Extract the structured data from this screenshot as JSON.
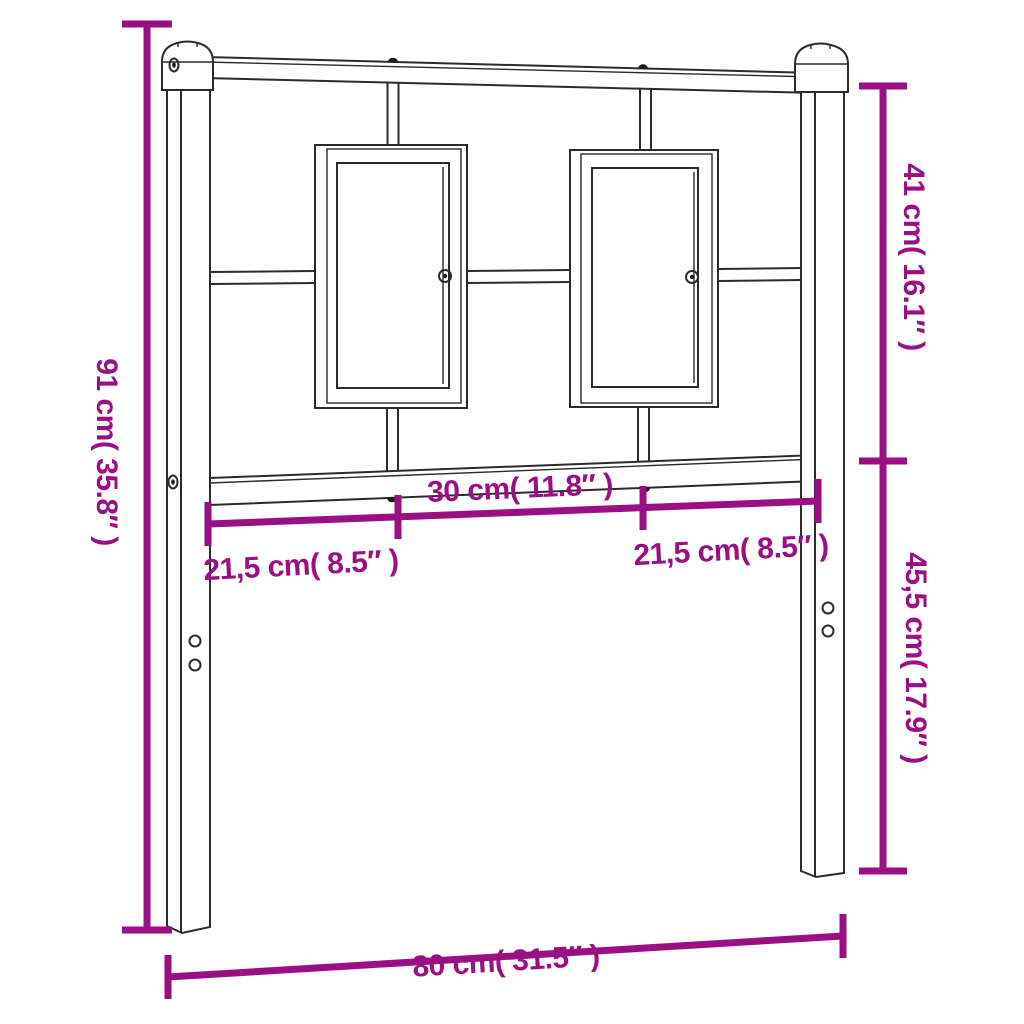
{
  "figure": {
    "type": "product-dimension-diagram",
    "subject": "metal-headboard",
    "colors": {
      "dimension_annotation": "#9A0F82",
      "drawing_outline": "#2B2B2B",
      "background": "#FFFFFF"
    },
    "dimensions": {
      "total_height": {
        "cm": "91",
        "in": "35.8",
        "label": "91 cm( 35.8″ )"
      },
      "upper_section_height": {
        "cm": "41",
        "in": "16.1",
        "label": "41 cm( 16.1″ )"
      },
      "lower_section_height": {
        "cm": "45,5",
        "in": "17.9",
        "label": "45,5 cm( 17.9″ )"
      },
      "center_width": {
        "cm": "30",
        "in": "11.8",
        "label": "30 cm( 11.8″ )"
      },
      "left_width": {
        "cm": "21,5",
        "in": "8.5",
        "label": "21,5 cm( 8.5″ )"
      },
      "right_width": {
        "cm": "21,5",
        "in": "8.5",
        "label": "21,5 cm( 8.5″ )"
      },
      "total_width": {
        "cm": "80",
        "in": "31.5",
        "label": "80 cm( 31.5″ )"
      }
    }
  }
}
